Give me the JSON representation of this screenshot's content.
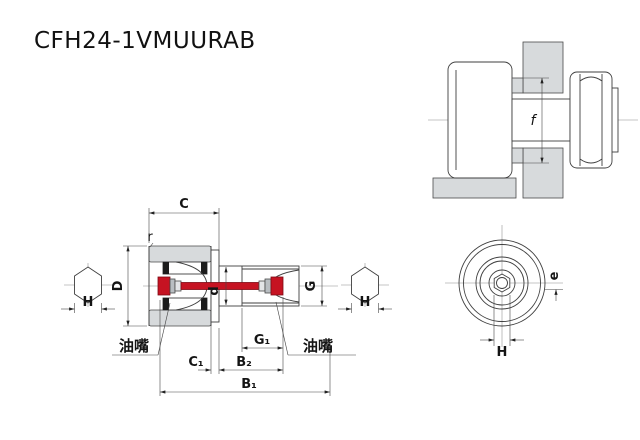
{
  "title": "CFH24-1VMUURAB",
  "colors": {
    "accent_red": "#c61322",
    "part_gray": "#d7dadc",
    "cone_gray": "#b9bec2",
    "cone_light": "#e3e5e7"
  },
  "section_view": {
    "dim_C": "C",
    "dim_r": "r",
    "dim_D": "D",
    "dim_d": "d",
    "dim_G": "G",
    "dim_G1": "G₁",
    "dim_C1": "C₁",
    "dim_B2": "B₂",
    "dim_B1": "B₁",
    "dim_H_left": "H",
    "dim_H_right": "H",
    "grease_left": "油嘴",
    "grease_right": "油嘴"
  },
  "mounted_view": {
    "dim_f": "f"
  },
  "end_view": {
    "dim_e": "e",
    "dim_H": "H"
  }
}
